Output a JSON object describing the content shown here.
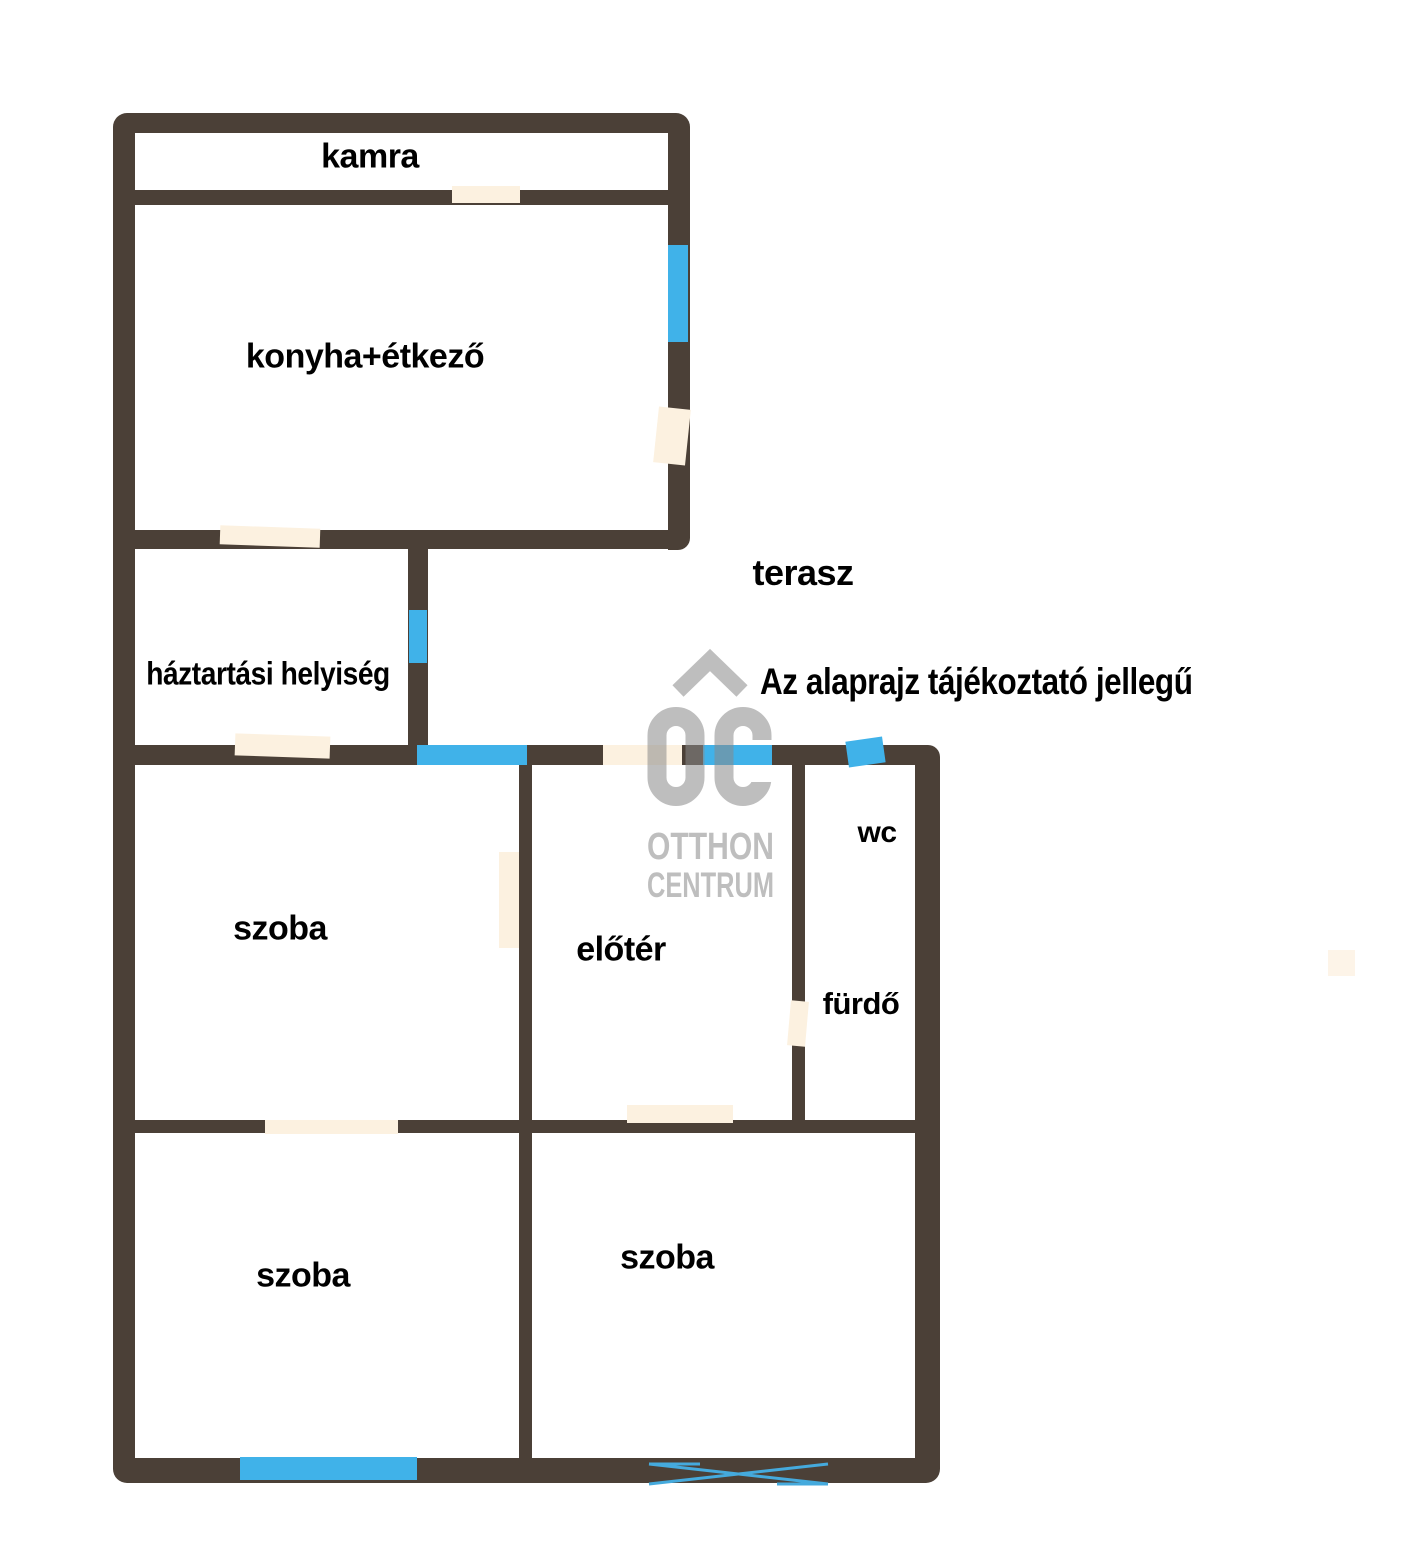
{
  "floorplan": {
    "rooms": {
      "kamra": "kamra",
      "konyha_etkezo": "konyha+étkező",
      "haztartasi_helyiseg": "háztartási helyiség",
      "terasz": "terasz",
      "szoba_felso": "szoba",
      "eloter": "előtér",
      "wc": "wc",
      "furdo": "fürdő",
      "szoba_also_bal": "szoba",
      "szoba_also_jobb": "szoba"
    },
    "disclaimer": "Az alaprajz tájékoztató jellegű"
  },
  "watermark": {
    "logo": "OC",
    "line1": "OTTHON",
    "line2": "CENTRUM"
  },
  "colors": {
    "background": "#ffffff",
    "wall": "#4b4037",
    "window": "#40b2e9",
    "door": "#fcf1e0",
    "door_faint": "#fdf4e8",
    "label": "#000000",
    "watermark": "#8a8a8a",
    "glass_line": "#45aadd"
  }
}
